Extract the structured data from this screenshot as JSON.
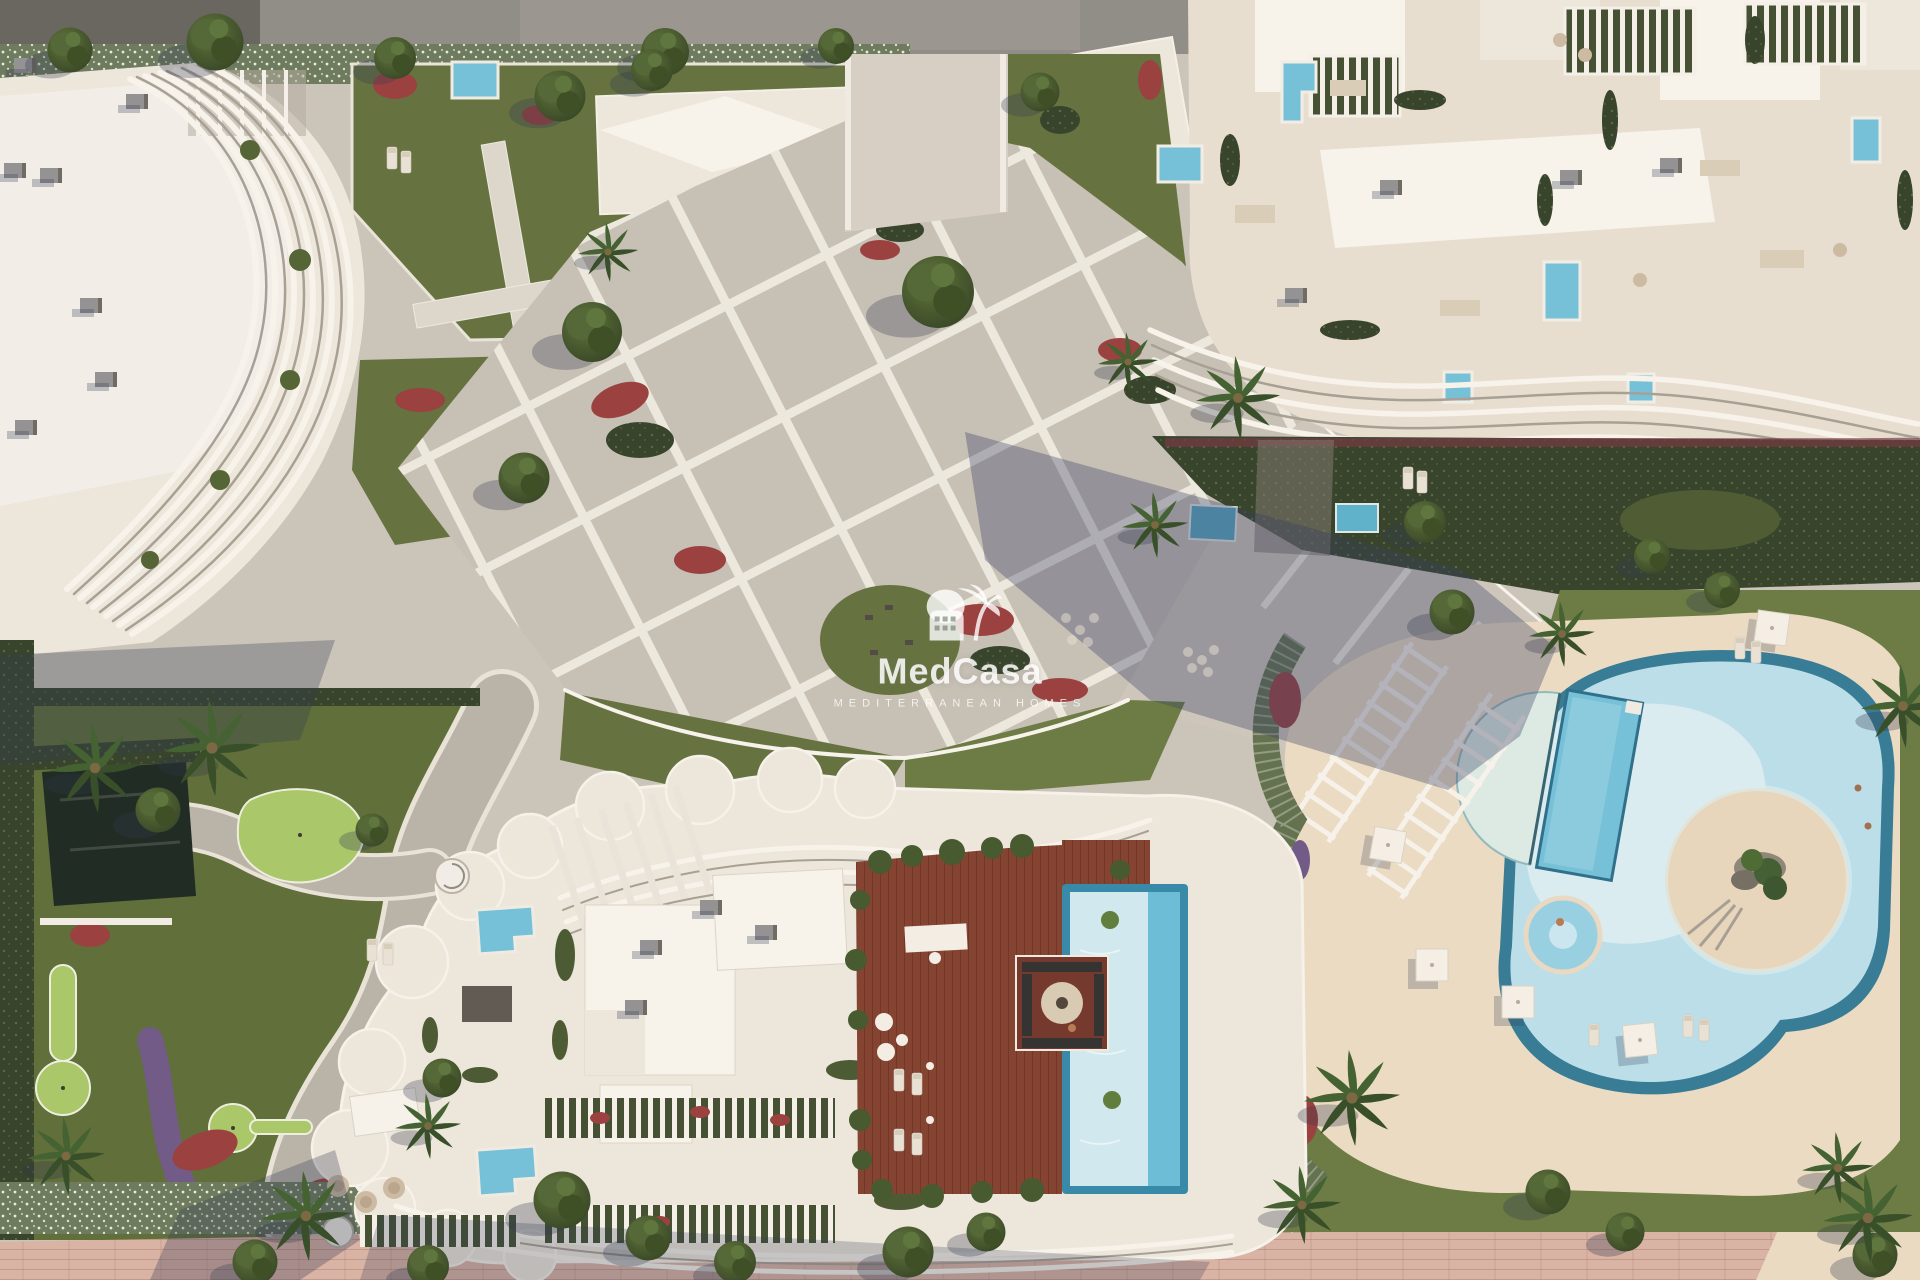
{
  "scene": {
    "kind": "aerial-architectural-render",
    "subject": "Mediterranean residential complex with sculpted white apartment buildings, rooftop pool deck, lagoon-style amenity pools, gardens and mini-golf green"
  },
  "watermark": {
    "brand": "MedCasa",
    "tagline": "MEDITERRANEAN HOMES",
    "logo_icon": "palm-house-icon"
  },
  "colors": {
    "paving": "#c9c3b9",
    "road": "#8c8985",
    "cream": "#ece7dd",
    "whiteRoof": "#f7f4ee",
    "stone": "#e7dfd2",
    "lawn": "#5e6e3c",
    "lawnBright": "#66783f",
    "putting": "#a6c766",
    "hedgeDark": "#2f3d26",
    "hedgeLight": "#67775a",
    "redFlower": "#963a3c",
    "purpleFlower": "#6b5584",
    "poolBlue": "#6fc0da",
    "poolRim": "#2e7894",
    "lagoon": "#b9dfec",
    "lagoonPale": "#dceff4",
    "sand": "#ebdcc4",
    "islandSand": "#e6d6bd",
    "deckWood": "#7f3b2c",
    "grayBox": "#8f8f92",
    "shadowBlue": "rgba(47,57,98,0.35)",
    "promenade": "#d7b1a3",
    "pondDark": "#16231e"
  }
}
